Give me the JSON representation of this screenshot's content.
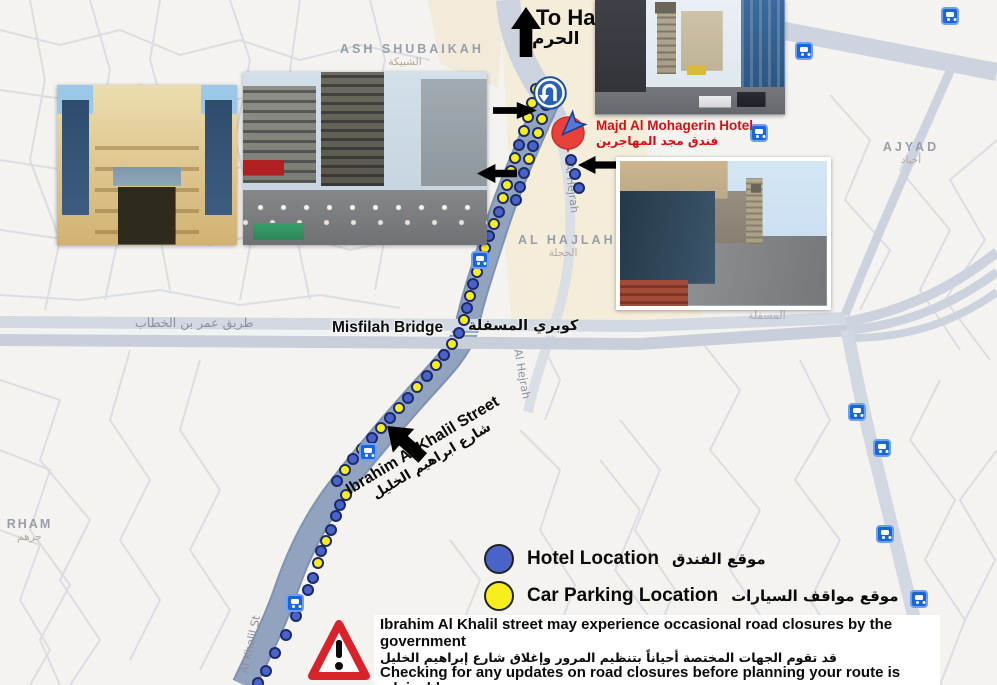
{
  "map": {
    "colors": {
      "parking_dot": "#f7ee1b",
      "hotel_dot": "#4a63c8",
      "dot_border": "#1c2a6a",
      "transit_bg": "#1a66d9",
      "route_road": "#92a3bf"
    },
    "to_haram": {
      "en": "To Haram",
      "ar": "الحرم"
    },
    "areas": {
      "ash_shubaikah": {
        "en": "ASH SHUBAIKAH",
        "ar": "الشبيكة"
      },
      "al_hajlah": {
        "en": "AL HAJLAH",
        "ar": "الحجلة"
      },
      "ajyad": {
        "en": "AJYAD",
        "ar": "أجياد"
      },
      "rham": {
        "en": "RHAM",
        "ar": "جرهم"
      }
    },
    "roads": {
      "omar_bin_al_khattab": "طريق عمر بن الخطاب",
      "misfilah_faint": "المسفلة",
      "al_hejrah": "Al Hejrah",
      "al_khalil_st": "Al Khalil St"
    },
    "bridge": {
      "en": "Misfilah Bridge",
      "ar": "كوبري المسفلة"
    },
    "hotel_label": {
      "en": "Majd Al Mohagerin Hotel",
      "ar": "فندق مجد المهاجرين"
    },
    "street_annotation": {
      "en": "Ibrahim Al Khalil Street",
      "ar": "شارع ابراهيم الخليل"
    },
    "route_dots": [
      [
        536,
        89,
        "y"
      ],
      [
        550,
        90,
        "y"
      ],
      [
        532,
        103,
        "y"
      ],
      [
        546,
        105,
        "y"
      ],
      [
        528,
        117,
        "y"
      ],
      [
        542,
        119,
        "y"
      ],
      [
        524,
        131,
        "y"
      ],
      [
        538,
        133,
        "y"
      ],
      [
        519,
        145,
        "b"
      ],
      [
        533,
        146,
        "b"
      ],
      [
        515,
        158,
        "y"
      ],
      [
        529,
        159,
        "y"
      ],
      [
        511,
        171,
        "y"
      ],
      [
        524,
        173,
        "b"
      ],
      [
        507,
        185,
        "y"
      ],
      [
        520,
        187,
        "b"
      ],
      [
        503,
        198,
        "y"
      ],
      [
        516,
        200,
        "b"
      ],
      [
        499,
        212,
        "b"
      ],
      [
        494,
        224,
        "y"
      ],
      [
        489,
        236,
        "b"
      ],
      [
        485,
        248,
        "y"
      ],
      [
        481,
        260,
        "b"
      ],
      [
        477,
        272,
        "y"
      ],
      [
        473,
        284,
        "b"
      ],
      [
        470,
        296,
        "y"
      ],
      [
        467,
        308,
        "b"
      ],
      [
        464,
        320,
        "y"
      ],
      [
        459,
        333,
        "b"
      ],
      [
        452,
        344,
        "y"
      ],
      [
        444,
        355,
        "b"
      ],
      [
        436,
        365,
        "y"
      ],
      [
        427,
        376,
        "b"
      ],
      [
        417,
        387,
        "y"
      ],
      [
        408,
        398,
        "b"
      ],
      [
        399,
        408,
        "y"
      ],
      [
        390,
        418,
        "b"
      ],
      [
        381,
        428,
        "y"
      ],
      [
        372,
        438,
        "b"
      ],
      [
        362,
        449,
        "y"
      ],
      [
        353,
        459,
        "b"
      ],
      [
        345,
        470,
        "y"
      ],
      [
        337,
        481,
        "b"
      ],
      [
        346,
        495,
        "y"
      ],
      [
        340,
        505,
        "b"
      ],
      [
        336,
        516,
        "b"
      ],
      [
        331,
        530,
        "b"
      ],
      [
        326,
        541,
        "y"
      ],
      [
        321,
        551,
        "b"
      ],
      [
        318,
        563,
        "y"
      ],
      [
        313,
        578,
        "b"
      ],
      [
        308,
        590,
        "b"
      ],
      [
        296,
        616,
        "b"
      ],
      [
        286,
        635,
        "b"
      ],
      [
        275,
        653,
        "b"
      ],
      [
        266,
        671,
        "b"
      ],
      [
        258,
        683,
        "b"
      ],
      [
        571,
        160,
        "b"
      ],
      [
        575,
        174,
        "b"
      ],
      [
        579,
        188,
        "b"
      ]
    ],
    "transit_stops": [
      [
        950,
        16
      ],
      [
        804,
        51
      ],
      [
        759,
        133
      ],
      [
        480,
        260
      ],
      [
        368,
        452
      ],
      [
        295,
        603
      ],
      [
        857,
        412
      ],
      [
        882,
        448
      ],
      [
        885,
        534
      ],
      [
        919,
        599
      ]
    ]
  },
  "legend": {
    "hotel": {
      "label_en": "Hotel Location",
      "label_ar": "موقع الفندق",
      "color": "#4a63c8"
    },
    "parking": {
      "label_en": "Car Parking Location",
      "label_ar": "موقع مواقف السيارات",
      "color": "#f7ee1b"
    }
  },
  "warning": {
    "en_1": "Ibrahim Al Khalil street may experience occasional road closures by the government",
    "ar_1": "قد تقوم الجهات المختصة أحياناً بتنظيم المرور وإغلاق شارع إبراهيم الخليل",
    "en_2": "Checking for any updates on road closures before planning your route is advisable",
    "ar_2": "يُنصح بالتحقق من التحديثات بشأن إغلاق الطرق قبل البدء برحلتك"
  },
  "photos": [
    {
      "id": "hotel-building-facade"
    },
    {
      "id": "street-view-ibrahim-al-khalil"
    },
    {
      "id": "street-view-clock-tower"
    },
    {
      "id": "hotel-entrance"
    }
  ]
}
